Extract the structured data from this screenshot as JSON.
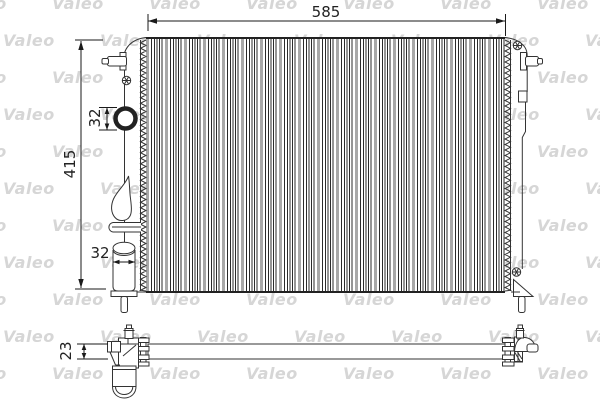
{
  "watermark": {
    "text": "Valeo",
    "color": "#d6d6d6"
  },
  "colors": {
    "line": "#333333",
    "dim": "#1a1a1a",
    "watermark": "#d6d6d6",
    "fin_gray": "#a8a8a8",
    "fin_dark": "#2b2b2b"
  },
  "dimensions": {
    "width": {
      "label": "585"
    },
    "height": {
      "label": "415"
    },
    "inlet_diameter": {
      "label": "32"
    },
    "filler_diameter": {
      "label": "32"
    },
    "depth": {
      "label": "23"
    }
  }
}
